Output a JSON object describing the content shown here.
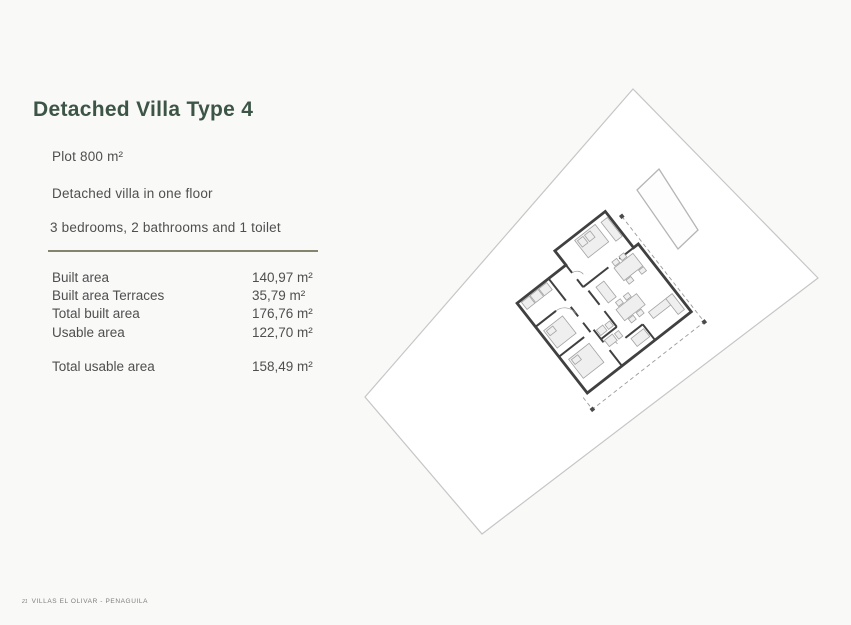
{
  "page": {
    "title": "Detached Villa Type 4",
    "background_color": "#f9f9f8"
  },
  "details": {
    "plot": "Plot 800 m²",
    "description": "Detached villa in one floor",
    "rooms": "3 bedrooms, 2 bathrooms and 1 toilet"
  },
  "areas": {
    "rows": [
      {
        "label": "Built area",
        "value": "140,97 m²"
      },
      {
        "label": "Built area Terraces",
        "value": "35,79 m²"
      },
      {
        "label": "Total built area",
        "value": "176,76 m²"
      },
      {
        "label": "Usable area",
        "value": "122,70 m²"
      }
    ],
    "total": {
      "label": "Total usable area",
      "value": "158,49 m²"
    }
  },
  "footer": {
    "page_number": "21",
    "brand": "VILLAS EL OLIVAR - PENAGUILA"
  },
  "colors": {
    "title_green": "#3d5547",
    "divider_olive": "#85856e",
    "body_text": "#4f4f4f",
    "plan_wall": "#404040",
    "plot_outline": "#c6c6c6"
  }
}
